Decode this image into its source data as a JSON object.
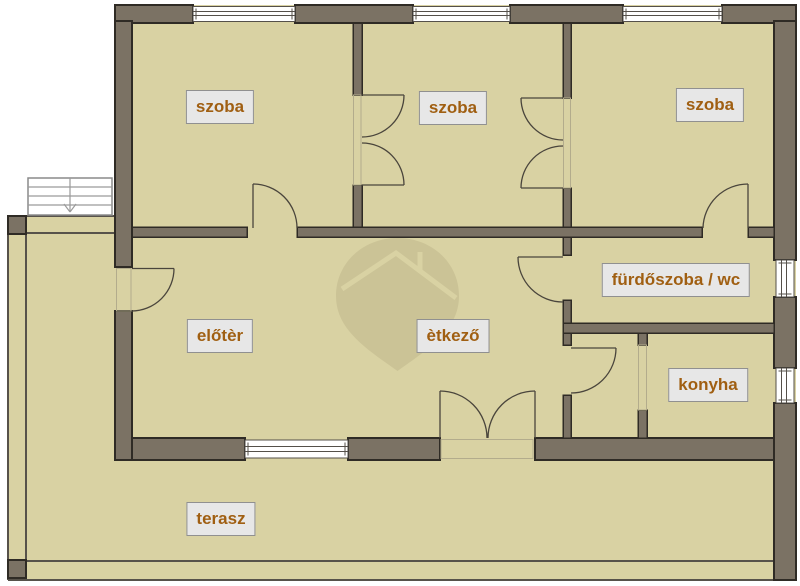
{
  "title": "floor-plan",
  "colors": {
    "wall": "#7b7264",
    "wall_outline": "#2f2b25",
    "floor": "#d9d2a3",
    "line_thin": "#57524a",
    "window_line": "#55504a",
    "door_line": "#4a453c",
    "label_bg": "#e7e7e7",
    "label_border": "#909090",
    "label_text": "#a05f12",
    "watermark": "#6f654222"
  },
  "icons": {
    "watermark": "map-pin-house-logo",
    "stairs": "staircase-with-down-arrow"
  },
  "rooms": {
    "szoba1": {
      "label": "szoba"
    },
    "szoba2": {
      "label": "szoba"
    },
    "szoba3": {
      "label": "szoba"
    },
    "furdoszoba": {
      "label": "fürdőszoba / wc"
    },
    "konyha": {
      "label": "konyha"
    },
    "eloter": {
      "label": "előtèr"
    },
    "etkezo": {
      "label": "ètkező"
    },
    "terasz": {
      "label": "terasz"
    }
  }
}
